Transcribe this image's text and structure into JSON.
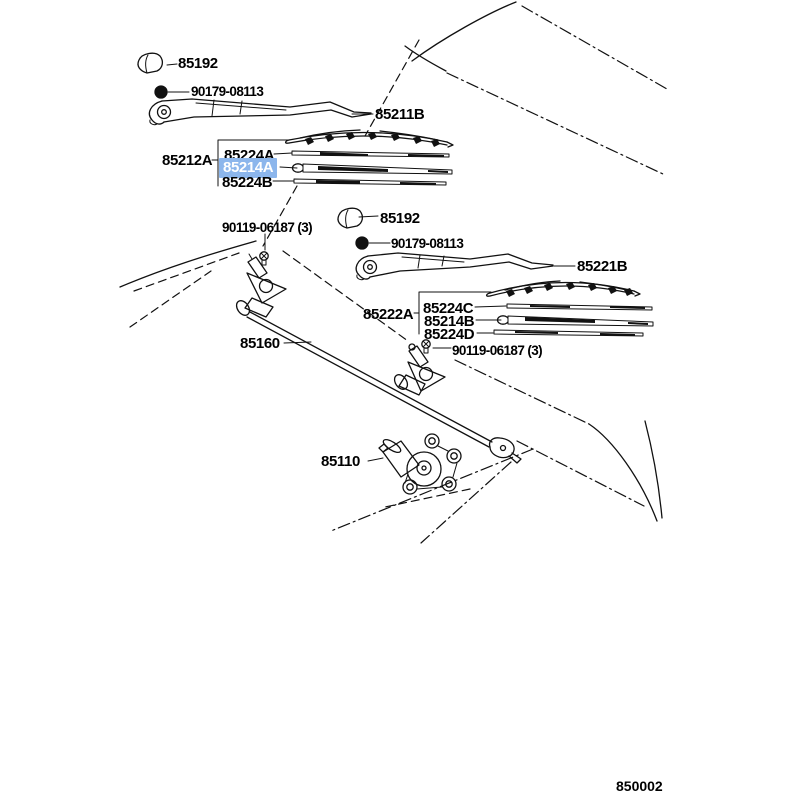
{
  "diagram": {
    "figure_number": "850002",
    "highlight_color": "#8cb6ec",
    "highlight_text_color": "#ffffff",
    "line_color": "#111111",
    "parts": [
      {
        "id": "cap-front",
        "number": "85192"
      },
      {
        "id": "nut-front",
        "number": "90179-08113"
      },
      {
        "id": "arm-front",
        "number": "85211B"
      },
      {
        "id": "blade-assy-front",
        "number": "85212A"
      },
      {
        "id": "backing-front-a",
        "number": "85224A"
      },
      {
        "id": "rubber-front",
        "number": "85214A",
        "highlighted": true
      },
      {
        "id": "backing-front-b",
        "number": "85224B"
      },
      {
        "id": "pivot-bolt-left",
        "number": "90119-06187 (3)"
      },
      {
        "id": "cap-rear",
        "number": "85192"
      },
      {
        "id": "nut-rear",
        "number": "90179-08113"
      },
      {
        "id": "arm-rear",
        "number": "85221B"
      },
      {
        "id": "blade-assy-rear",
        "number": "85222A"
      },
      {
        "id": "backing-rear-c",
        "number": "85224C"
      },
      {
        "id": "rubber-rear",
        "number": "85214B"
      },
      {
        "id": "backing-rear-d",
        "number": "85224D"
      },
      {
        "id": "pivot-bolt-right",
        "number": "90119-06187 (3)"
      },
      {
        "id": "linkage",
        "number": "85160"
      },
      {
        "id": "motor",
        "number": "85110"
      }
    ]
  }
}
